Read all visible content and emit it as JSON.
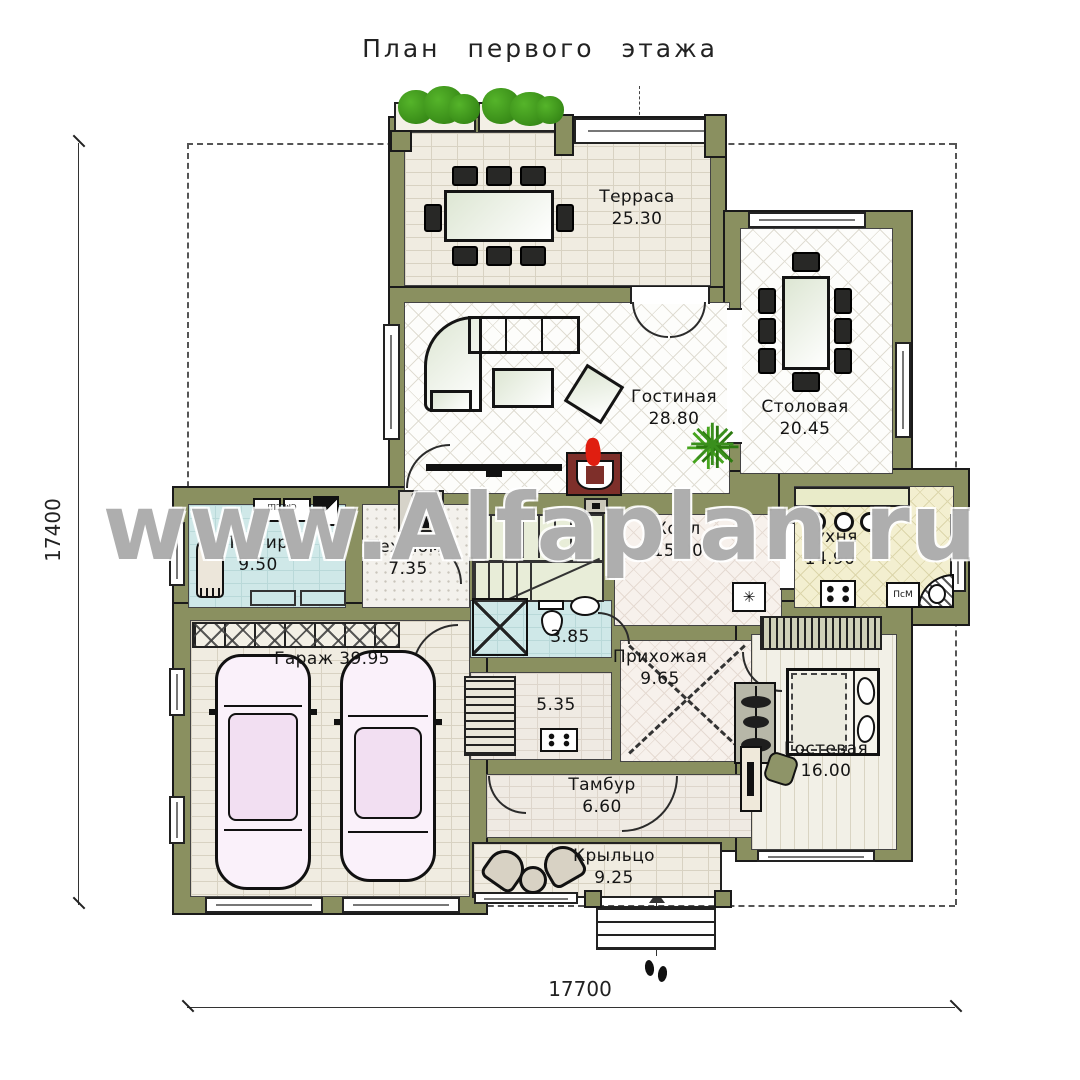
{
  "title": "План первого этажа",
  "watermark": "www.Alfaplan.ru",
  "dimensions": {
    "height": "17400",
    "width": "17700"
  },
  "rooms": {
    "terrace": {
      "name": "Терраса",
      "area": "25.30"
    },
    "living": {
      "name": "Гостиная",
      "area": "28.80"
    },
    "dining": {
      "name": "Столовая",
      "area": "20.45"
    },
    "kitchen": {
      "name": "Кухня",
      "area": "14.90"
    },
    "hall": {
      "name": "Холл",
      "area": "15.00"
    },
    "laundry": {
      "name": "Постир.",
      "area": "9.50"
    },
    "tech": {
      "name": "Тех.пом.",
      "area": "7.35"
    },
    "garage": {
      "name": "Гараж",
      "area": "39.95"
    },
    "bath": {
      "area": "3.85"
    },
    "closet": {
      "area": "5.35"
    },
    "entry": {
      "name": "Прихожая",
      "area": "9.65"
    },
    "vestibule": {
      "name": "Тамбур",
      "area": "6.60"
    },
    "porch": {
      "name": "Крыльцо",
      "area": "9.25"
    },
    "guest": {
      "name": "Гостевая",
      "area": "16.00"
    }
  },
  "equipment": {
    "dishwasher": "ПсМ",
    "boiler": "ОКБ",
    "laundry_units": "СМ СШ"
  },
  "colors": {
    "wall": "#8a9060",
    "flame": "#e01e10",
    "plant": "#3a8f1d"
  }
}
